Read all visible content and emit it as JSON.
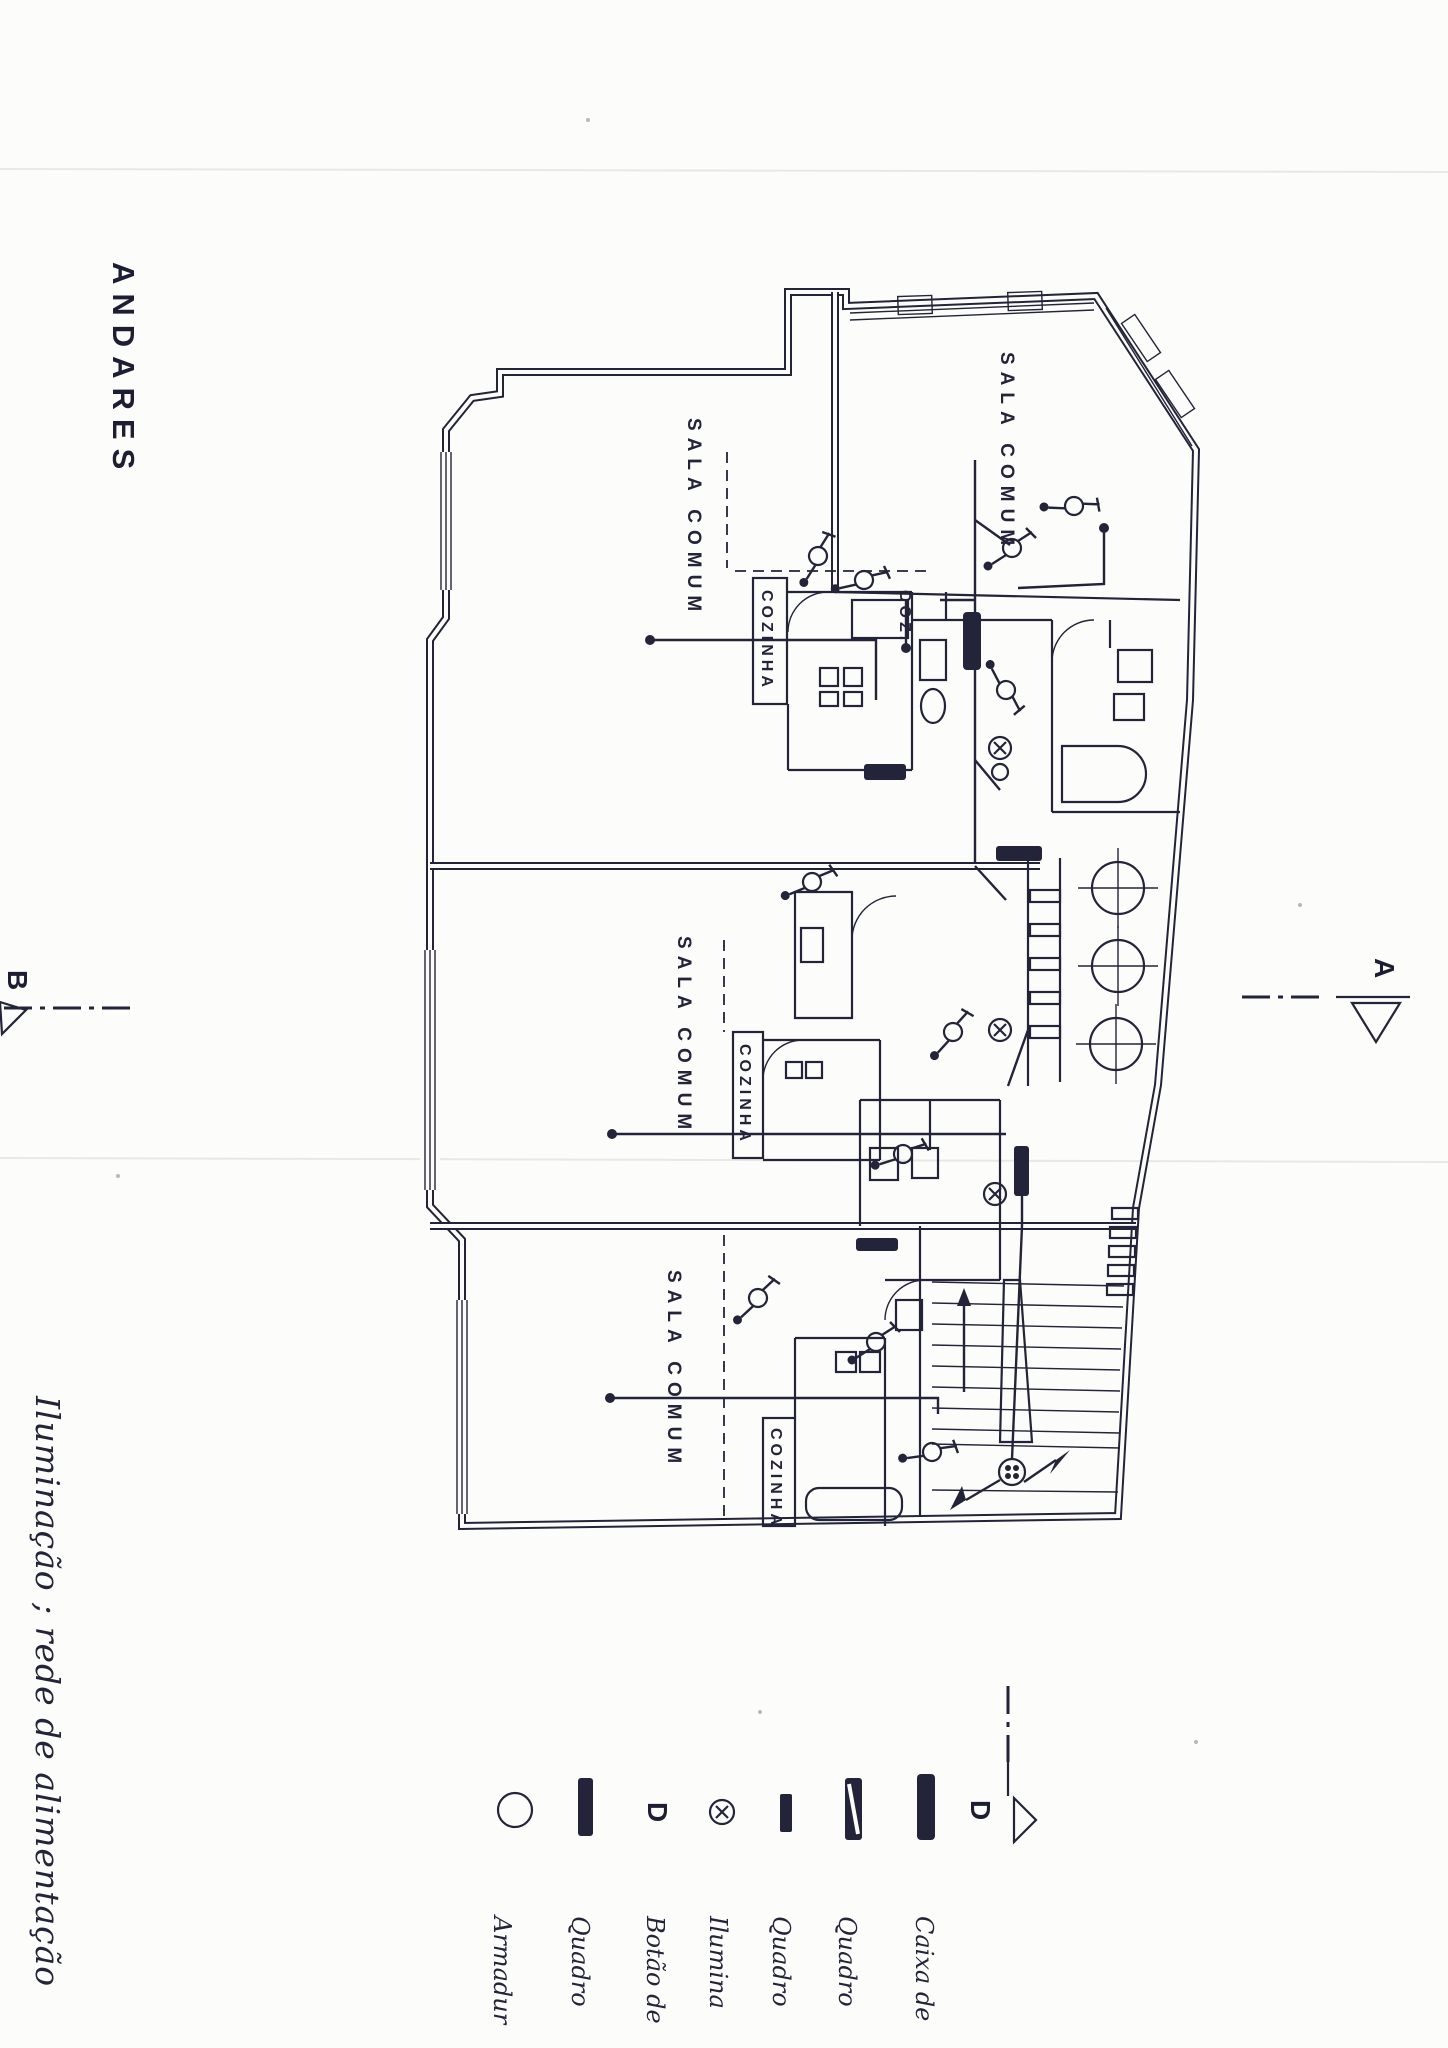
{
  "title": "ANDARES",
  "caption": "Iluminação ; rede de alimentação",
  "plan": {
    "rooms": {
      "sala_comum": "SALA COMUM",
      "cozinha": "COZINHA",
      "cozinha_abbrev": "COZ."
    }
  },
  "section_markers": {
    "a": "A",
    "b": "B",
    "d": "D"
  },
  "legend": {
    "d_glyph": "D",
    "items": [
      {
        "symbol": "circle-outline",
        "label": "Armadur"
      },
      {
        "symbol": "bar-tall-solid",
        "label": "Quadro"
      },
      {
        "symbol": "letter-d",
        "label": "Botão de"
      },
      {
        "symbol": "circled-cross",
        "label": "Ilumina"
      },
      {
        "symbol": "bar-small-solid",
        "label": "Quadro"
      },
      {
        "symbol": "bar-diagonal",
        "label": "Quadro"
      },
      {
        "symbol": "bar-thick-solid",
        "label": "Caixa de"
      }
    ]
  },
  "colors": {
    "ink": "#23233a",
    "paper": "#fcfcfa"
  }
}
